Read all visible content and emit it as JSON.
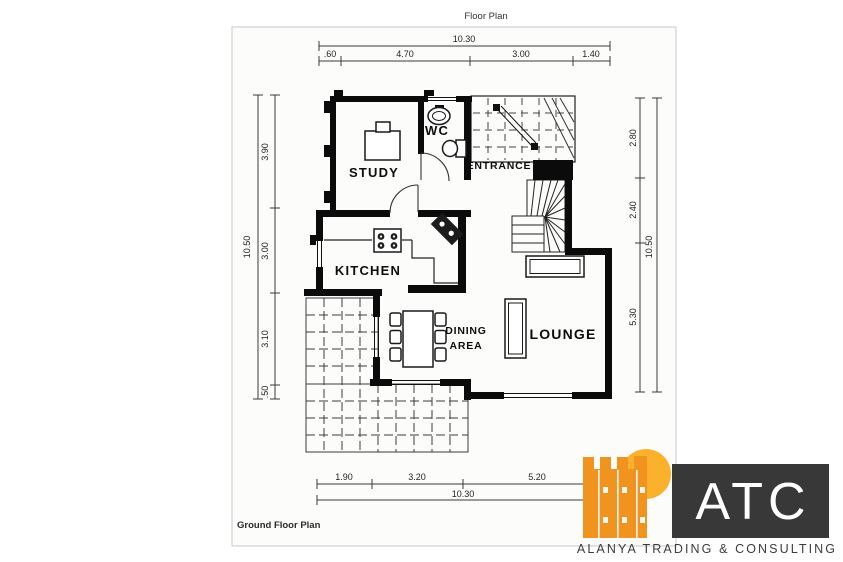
{
  "document": {
    "title": "Floor Plan",
    "footer": "Ground Floor Plan"
  },
  "rooms": {
    "study": "STUDY",
    "wc": "WC",
    "entrance": "ENTRANCE",
    "kitchen": "KITCHEN",
    "dining_line1": "DINING",
    "dining_line2": "AREA",
    "lounge": "LOUNGE"
  },
  "dimensions": {
    "top": {
      "total": "10.30",
      "segments": [
        ".60",
        "4.70",
        "3.00",
        "1.40"
      ]
    },
    "bottom": {
      "total": "10.30",
      "segments": [
        "1.90",
        "3.20",
        "5.20"
      ]
    },
    "left": {
      "total": "10.50",
      "segments": [
        "3.90",
        "3.00",
        "3.10",
        ".50"
      ]
    },
    "right": {
      "total": "10.50",
      "segments": [
        "2.80",
        "2.40",
        "5.30"
      ]
    }
  },
  "logo": {
    "abbr": "ATC",
    "company": "ALANYA TRADING & CONSULTING",
    "colors": {
      "castle": "#F0941F",
      "sun": "#FBB12B",
      "box": "#383838"
    }
  }
}
